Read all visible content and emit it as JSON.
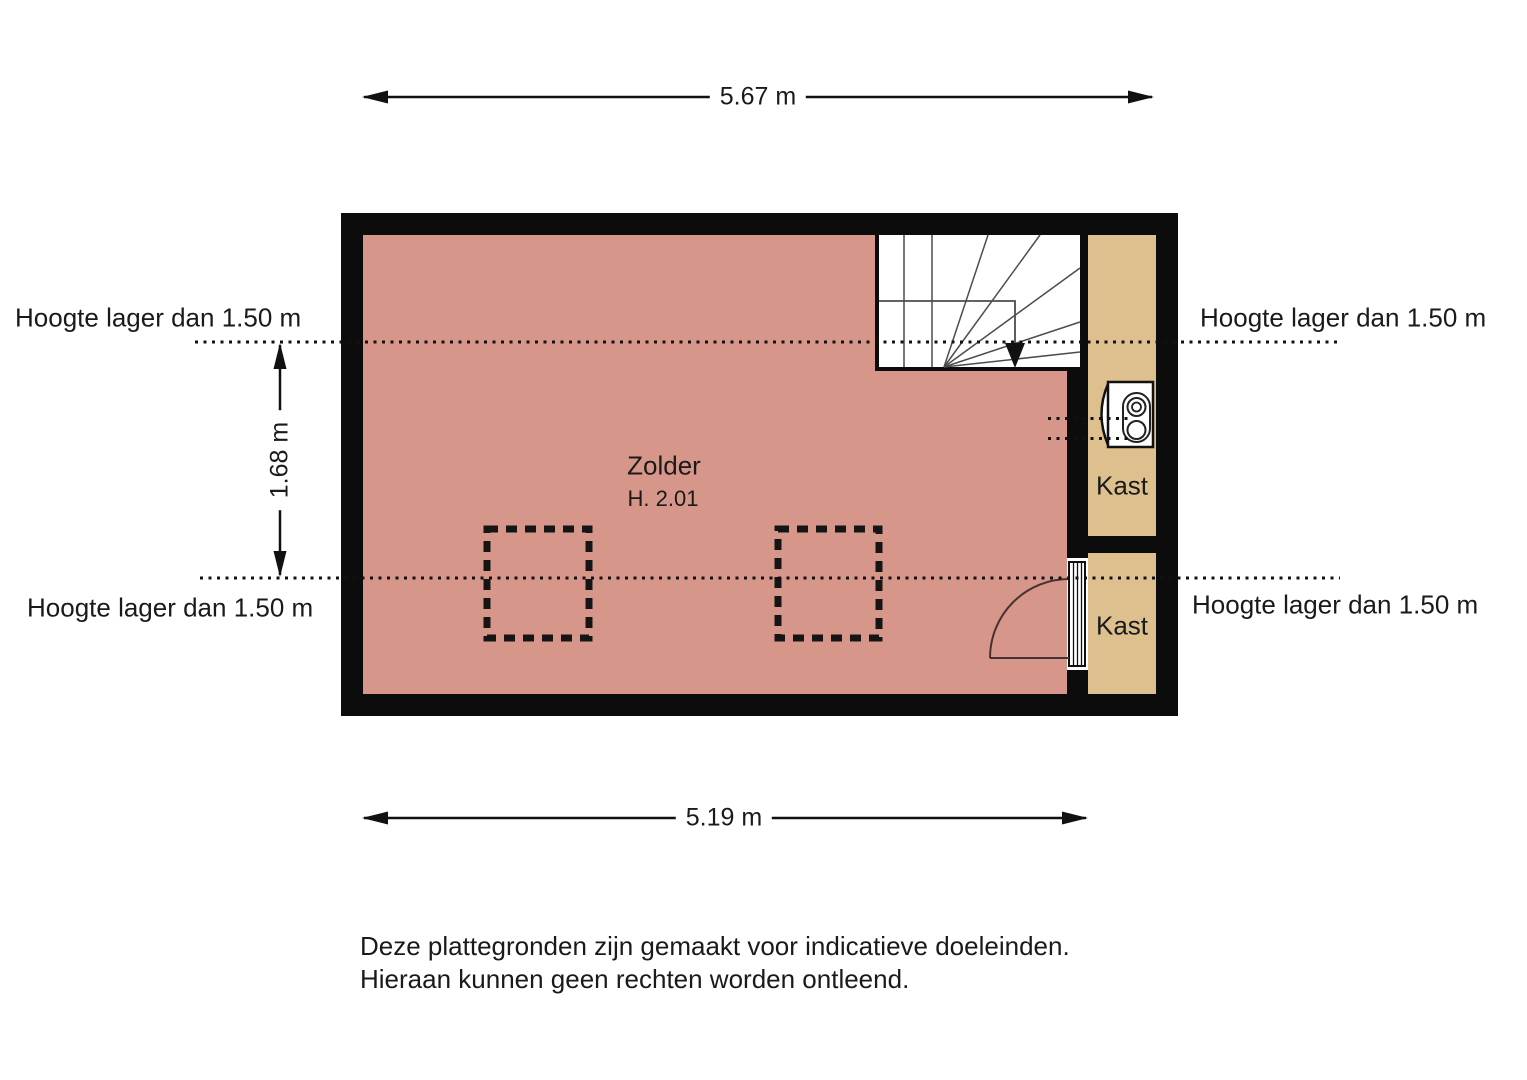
{
  "colors": {
    "room_fill": "#d7968a",
    "closet_fill": "#dec08e",
    "wall": "#0c0c0c",
    "stair_line": "#4d4d4d",
    "door_line": "#463232"
  },
  "dimensions": {
    "width_top": "5.67 m",
    "width_bottom": "5.19 m",
    "height_left": "1.68 m"
  },
  "height_annotations": {
    "top_left": "Hoogte lager dan 1.50 m",
    "top_right": "Hoogte lager dan 1.50 m",
    "bottom_left": "Hoogte lager dan 1.50 m",
    "bottom_right": "Hoogte lager dan 1.50 m"
  },
  "rooms": {
    "attic": {
      "name": "Zolder",
      "height": "H. 2.01"
    },
    "closet_top": {
      "name": "Kast"
    },
    "closet_bottom": {
      "name": "Kast"
    }
  },
  "disclaimer": {
    "line1": "Deze plattegronden zijn gemaakt voor indicatieve doeleinden.",
    "line2": "Hieraan kunnen geen rechten worden ontleend."
  }
}
